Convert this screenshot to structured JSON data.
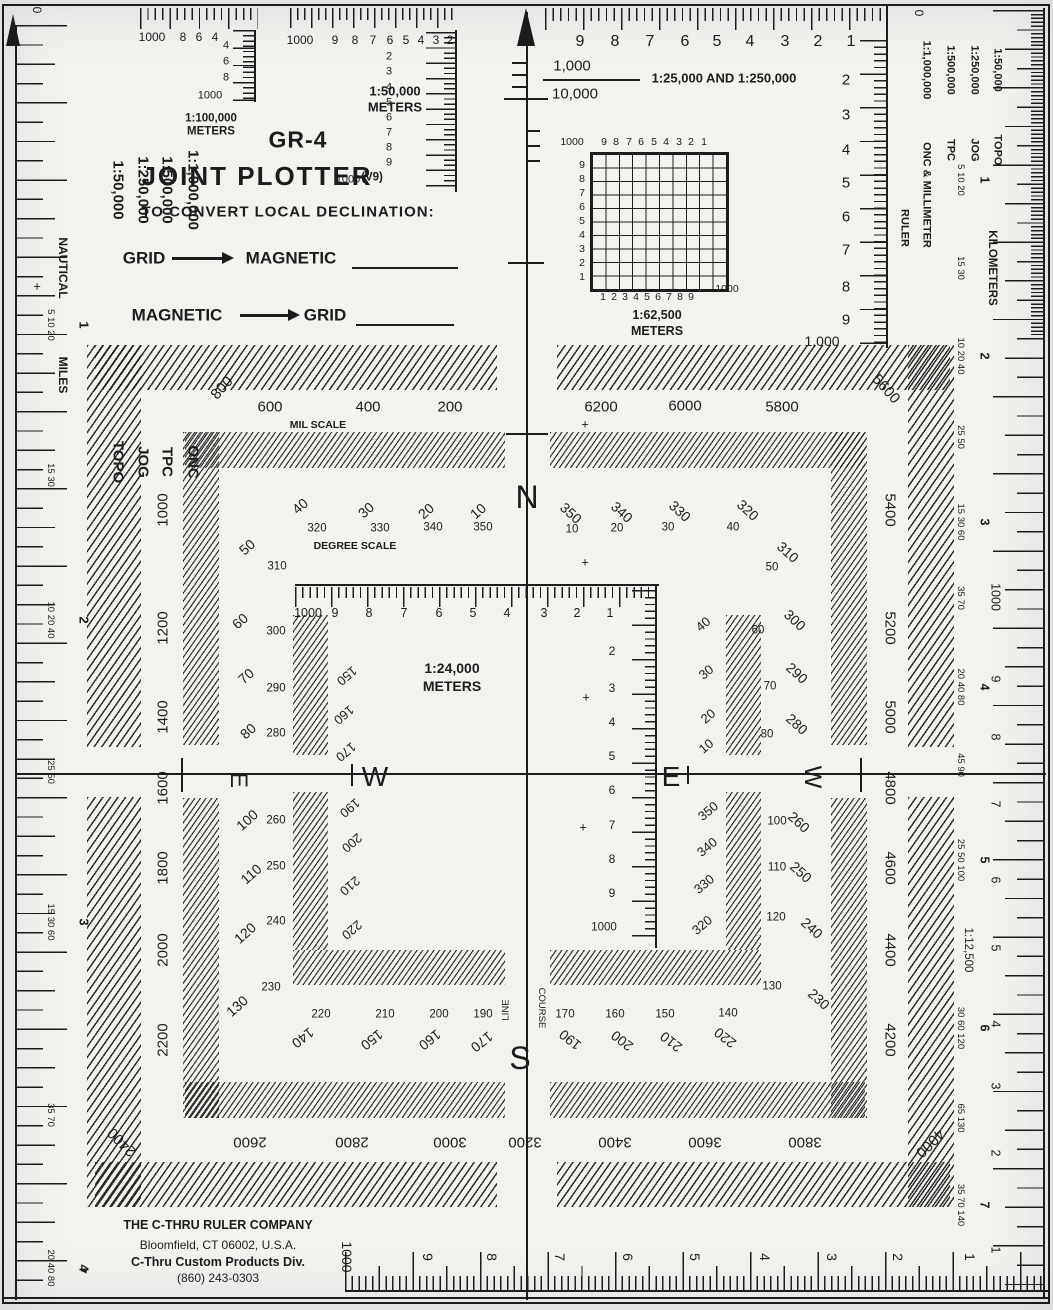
{
  "title": {
    "model": "GR-4",
    "name": "JOINT PLOTTER",
    "version": "(V9)"
  },
  "declination": {
    "heading": "TO CONVERT LOCAL DECLINATION:",
    "row1_from": "GRID",
    "row1_to": "MAGNETIC",
    "row2_from": "MAGNETIC",
    "row2_to": "GRID",
    "plus": "+"
  },
  "company": {
    "line1": "THE C-THRU RULER COMPANY",
    "line2": "Bloomfield, CT 06002, U.S.A.",
    "line3": "C-Thru Custom Products Div.",
    "line4": "(860) 243-0303"
  },
  "left_edge": {
    "zero": "0",
    "nautical": "NAUTICAL",
    "miles": "MILES",
    "plus": "+",
    "arrow": "◄",
    "scales": [
      {
        "name": "1:50,000",
        "type": "TOPO"
      },
      {
        "name": "1:250,000",
        "type": "JOG"
      },
      {
        "name": "1:500,000",
        "type": "TPC"
      },
      {
        "name": "1:1,000,000",
        "type": "ONC"
      }
    ],
    "clusters": [
      {
        "main": "1",
        "subs": "5 10 20"
      },
      {
        "main": "",
        "subs": "15 30"
      },
      {
        "main": "2",
        "subs": "10 20 40"
      },
      {
        "main": "",
        "subs": "25 50"
      },
      {
        "main": "3",
        "subs": "15 30 60"
      },
      {
        "main": "",
        "subs": "35 70"
      },
      {
        "main": "4",
        "subs": "20 40 80"
      }
    ]
  },
  "right_edge": {
    "zero": "0",
    "ruler_word": "RULER",
    "kilometers": "KILOMETERS",
    "scale_12500": "1:12,500",
    "scales": [
      {
        "name": "1:50,000",
        "type": "TOPO"
      },
      {
        "name": "1:250,000",
        "type": "JOG"
      },
      {
        "name": "1:500,000",
        "type": "TPC"
      },
      {
        "name": "1:1,000,000",
        "type": "ONC & MILLIMETER"
      }
    ],
    "clusters": [
      {
        "main": "1",
        "subs": "5 10 20"
      },
      {
        "main": "",
        "subs": "15 30"
      },
      {
        "main": "2",
        "subs": "10 20 40"
      },
      {
        "main": "",
        "subs": "25 50"
      },
      {
        "main": "3",
        "subs": "15 30 60"
      },
      {
        "main": "",
        "subs": "35 70"
      },
      {
        "main": "4",
        "subs": "20 40 80"
      },
      {
        "main": "",
        "subs": "45 90"
      },
      {
        "main": "5",
        "subs": "25 50 100"
      },
      {
        "main": "6",
        "subs": "30 60 120"
      },
      {
        "main": "",
        "subs": "65 130"
      },
      {
        "main": "7",
        "subs": "35 70 140"
      }
    ],
    "meter_numbers": [
      "1000",
      "9",
      "8",
      "7",
      "6",
      "5",
      "4",
      "3",
      "2",
      "1"
    ]
  },
  "rulers": {
    "m100k": {
      "label1": "1:100,000",
      "label2": "METERS",
      "h": [
        "1000",
        "8",
        "6",
        "4"
      ],
      "v": [
        "4",
        "6",
        "8"
      ],
      "v_end": "1000"
    },
    "m50k": {
      "label1": "1:50,000",
      "label2": "METERS",
      "h": [
        "1000",
        "9",
        "8",
        "7",
        "6",
        "5",
        "4",
        "3",
        "2"
      ],
      "v": [
        "2",
        "3",
        "4",
        "5",
        "6",
        "7",
        "8",
        "9"
      ],
      "v_end": "1000"
    },
    "m25k": {
      "label": "1:25,000  AND  1:250,000",
      "numerator": "1,000",
      "denominator": "10,000",
      "h": [
        "9",
        "8",
        "7",
        "6",
        "5",
        "4",
        "3",
        "2",
        "1"
      ],
      "v": [
        "2",
        "3",
        "4",
        "5",
        "6",
        "7",
        "8",
        "9"
      ],
      "v_end": "1,000"
    },
    "m62k": {
      "label1": "1:62,500",
      "label2": "METERS",
      "top_start": "1000",
      "top": [
        "9",
        "8",
        "7",
        "6",
        "5",
        "4",
        "3",
        "2",
        "1"
      ],
      "left": [
        "9",
        "8",
        "7",
        "6",
        "5",
        "4",
        "3",
        "2",
        "1"
      ],
      "bottom": [
        "1",
        "2",
        "3",
        "4",
        "5",
        "6",
        "7",
        "8",
        "9"
      ],
      "corner": "1000"
    },
    "m24k": {
      "label1": "1:24,000",
      "label2": "METERS",
      "h": [
        "1000",
        "9",
        "8",
        "7",
        "6",
        "5",
        "4",
        "3",
        "2",
        "1"
      ],
      "v": [
        "2",
        "3",
        "4",
        "5",
        "6",
        "7",
        "8",
        "9"
      ],
      "v_end": "1000"
    },
    "bottom_ruler": {
      "numbers": [
        "1000",
        "9",
        "8",
        "7",
        "6",
        "5",
        "4",
        "3",
        "2",
        "1"
      ]
    }
  },
  "protractor": {
    "mil_label": "MIL SCALE",
    "degree_label": "DEGREE SCALE",
    "plus": "+",
    "cardinal_n": "N",
    "cardinal_s": "S",
    "cardinal_e": "E",
    "cardinal_w": "W",
    "course": "COURSE",
    "line": "LINE",
    "mils_top_left": [
      "600",
      "400",
      "200"
    ],
    "mils_top_right": [
      "6200",
      "6000",
      "5800"
    ],
    "mils_left": [
      "1000",
      "1200",
      "1400",
      "1600",
      "1800",
      "2000",
      "2200"
    ],
    "mils_right": [
      "5400",
      "5200",
      "5000",
      "4800",
      "4600",
      "4400",
      "4200"
    ],
    "mils_bottom": [
      "2600",
      "2800",
      "3000",
      "3200",
      "3400",
      "3600",
      "3800"
    ],
    "corner_tl": "800",
    "corner_tr": "5600",
    "corner_bl": "2400",
    "corner_br": "4000",
    "deg_top_left_rot": [
      "40",
      "30",
      "20",
      "10"
    ],
    "deg_top_left_static": [
      "320",
      "330",
      "340",
      "350"
    ],
    "deg_top_right_rot": [
      "350",
      "340",
      "330",
      "320"
    ],
    "deg_top_right_static": [
      "10",
      "20",
      "30",
      "40"
    ],
    "deg_left_rot": [
      "50",
      "60",
      "70",
      "80",
      "100",
      "110",
      "120",
      "130"
    ],
    "deg_left_static": [
      "310",
      "300",
      "290",
      "280",
      "260",
      "250",
      "240",
      "230"
    ],
    "deg_right_rot": [
      "310",
      "300",
      "290",
      "280",
      "260",
      "250",
      "240",
      "230"
    ],
    "deg_right_static": [
      "50",
      "60",
      "70",
      "80",
      "100",
      "110",
      "120",
      "130"
    ],
    "deg_bottom_left_static": [
      "220",
      "210",
      "200",
      "190"
    ],
    "deg_bottom_left_rot": [
      "140",
      "150",
      "160",
      "170"
    ],
    "deg_bottom_right_static": [
      "170",
      "160",
      "150",
      "140"
    ],
    "deg_bottom_right_rot": [
      "190",
      "200",
      "210",
      "220"
    ],
    "inner_left_rot": [
      "150",
      "160",
      "170",
      "190",
      "200",
      "210",
      "220"
    ],
    "inner_right_rot": [
      "40",
      "30",
      "20",
      "10",
      "350",
      "340",
      "330",
      "320"
    ]
  }
}
